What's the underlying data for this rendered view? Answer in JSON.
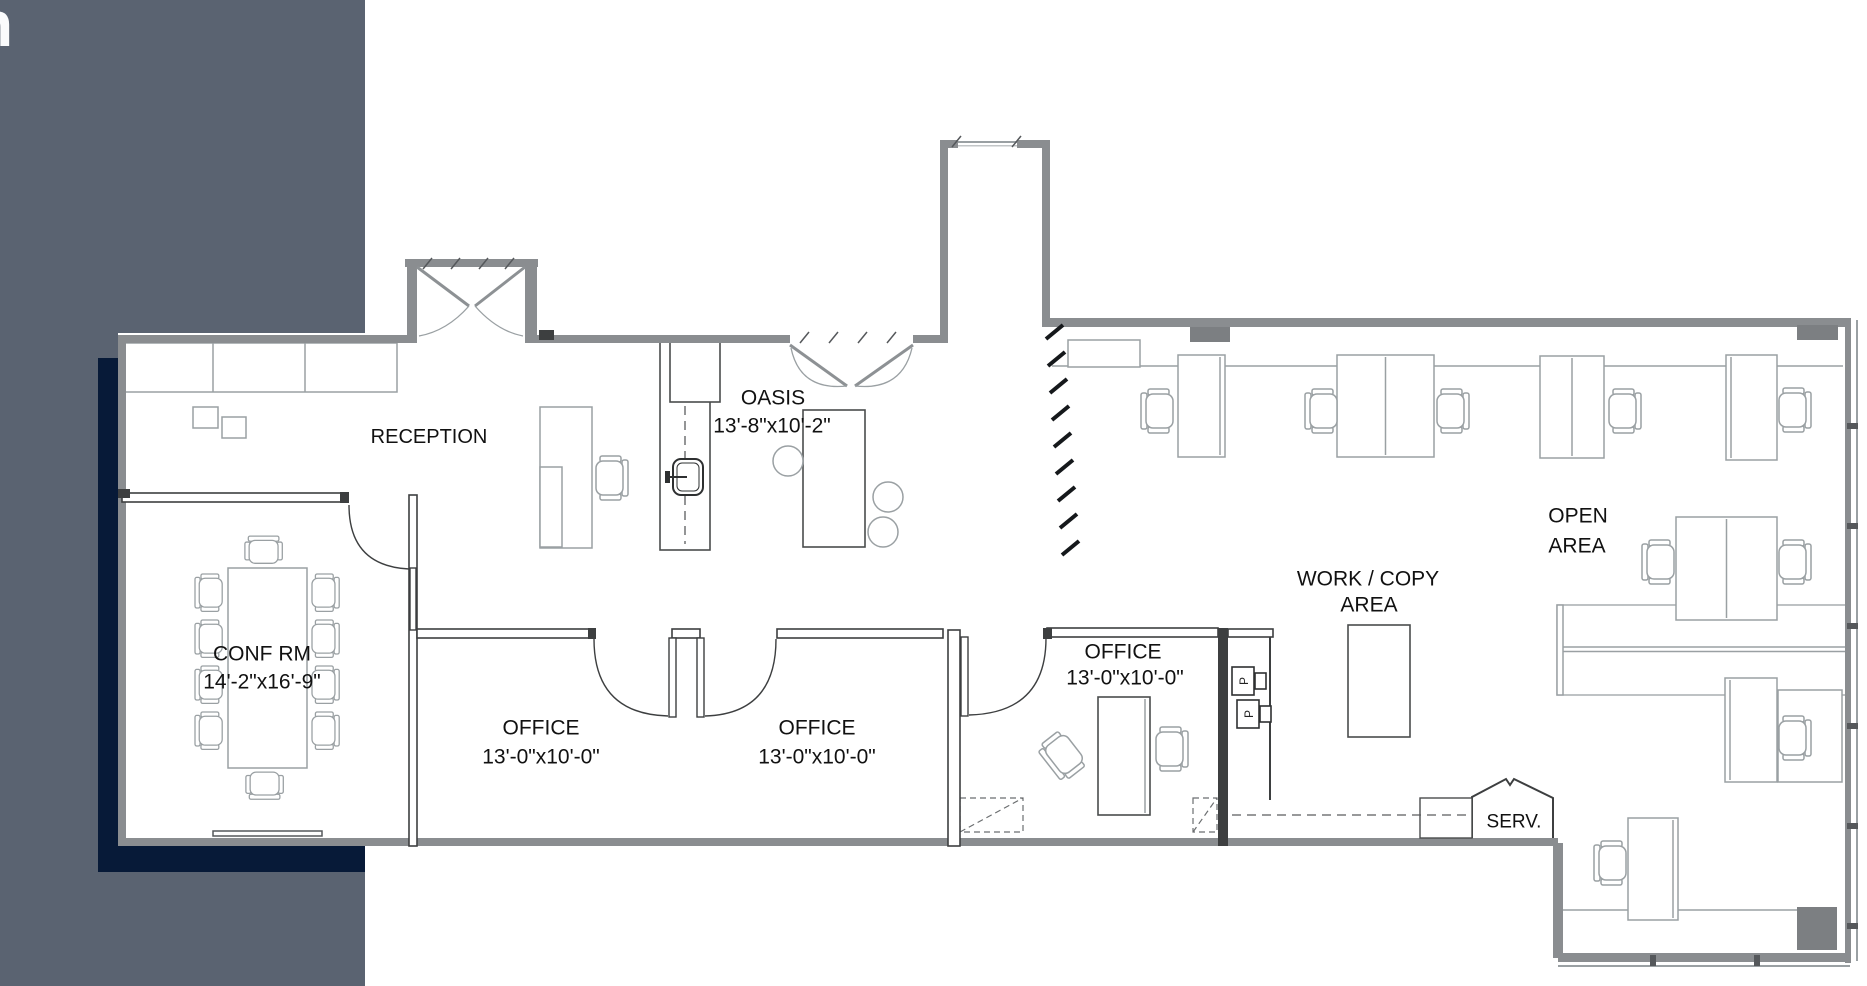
{
  "window": {
    "logo_letter": "n"
  },
  "palette": {
    "sidebar": "#5a6371",
    "accent_band": "#071a38",
    "paper": "#ffffff",
    "ink": "#111111"
  },
  "rooms": {
    "reception": {
      "label": "RECEPTION"
    },
    "oasis": {
      "label": "OASIS",
      "dims": "13'-8\"x10'-2\""
    },
    "conference": {
      "label": "CONF RM",
      "dims": "14'-2\"x16'-9\""
    },
    "office_1": {
      "label": "OFFICE",
      "dims": "13'-0\"x10'-0\""
    },
    "office_2": {
      "label": "OFFICE",
      "dims": "13'-0\"x10'-0\""
    },
    "office_3": {
      "label": "OFFICE",
      "dims": "13'-0\"x10'-0\""
    },
    "work_copy": {
      "label": "WORK / COPY",
      "label_line2": "AREA"
    },
    "open_area": {
      "label": "OPEN",
      "label_line2": "AREA"
    },
    "service": {
      "label": "SERV."
    }
  },
  "equipment": {
    "printer_1": "P",
    "printer_2": "P"
  }
}
